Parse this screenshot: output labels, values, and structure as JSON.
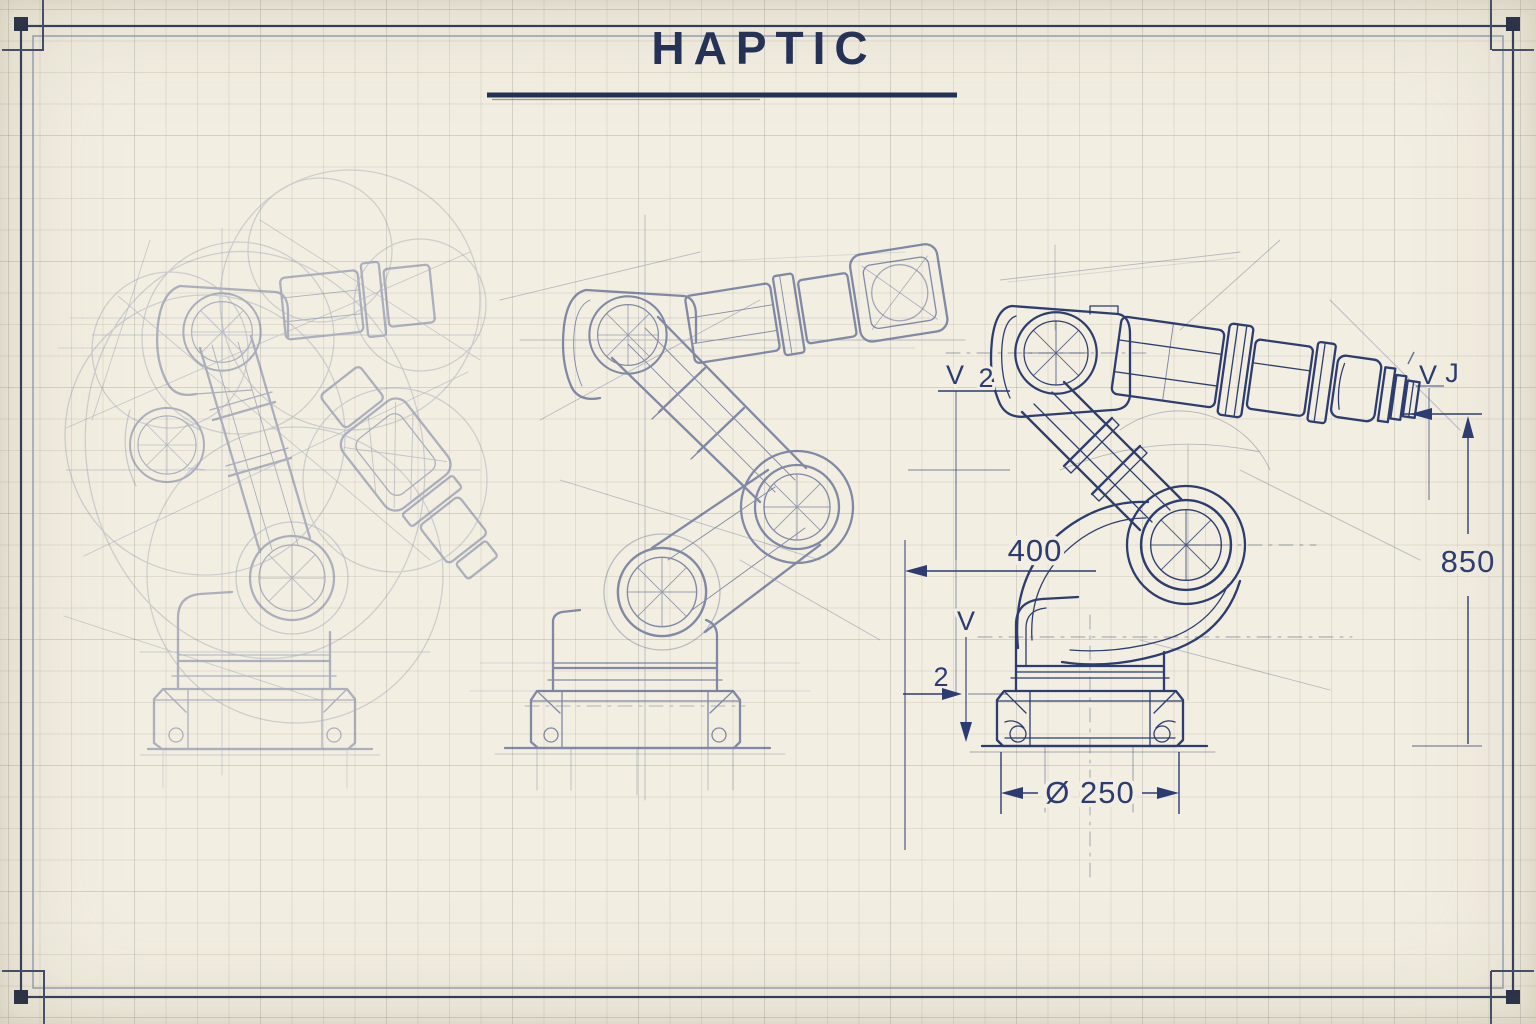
{
  "sheet": {
    "title": "HAPTIC",
    "paper_color": "#f2eee1",
    "ink_color": "#26376b",
    "title_color": "#1f2e55"
  },
  "annotations": {
    "horizontal_reach": "400",
    "vertical_height": "850",
    "base_diameter": "Ø 250",
    "callout_top_v": "V",
    "callout_top_num": "2",
    "callout_mid_v": "V",
    "callout_mid_num": "2",
    "callout_right_v": "V",
    "callout_right_j": "J"
  }
}
